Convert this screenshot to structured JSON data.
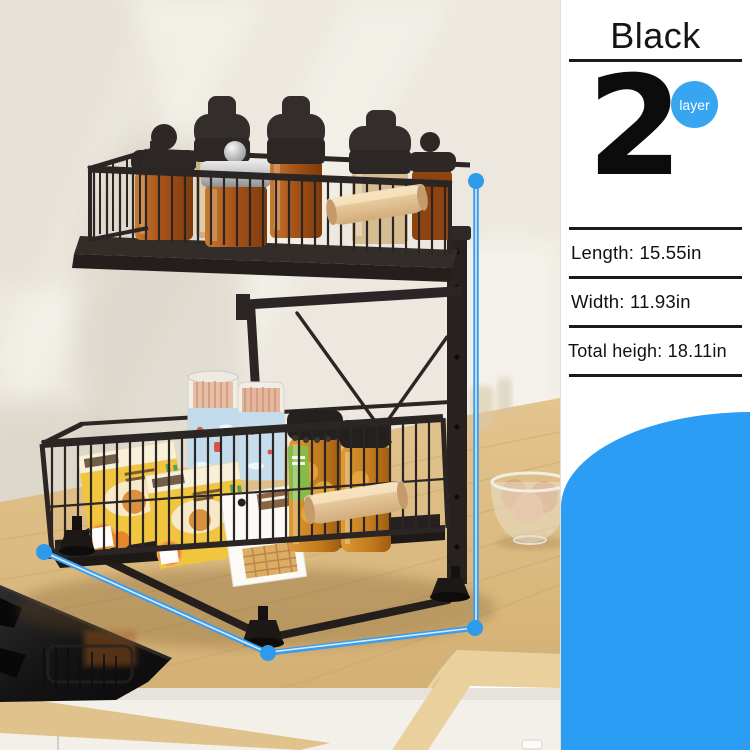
{
  "product_card": {
    "color_title": "Black",
    "layer_count": "2",
    "layer_badge_label": "layer",
    "specs": [
      {
        "label": "Length: 15.55in"
      },
      {
        "label": "Width: 11.93in"
      },
      {
        "label": "Total heigh: 18.11in"
      }
    ]
  },
  "colors": {
    "badge_blue": "#38A5F1",
    "corner_shape_blue": "#2B9DF4",
    "dimension_marker_blue": "#3B9DEB",
    "panel_divider_black": "#1A1A1A",
    "wall_cream": "#EDE9E0",
    "wood_counter": "#DCBC85",
    "rack_black": "#2B2524",
    "jar_amber": "#B05A1A",
    "snack_box_yellow": "#F2C53F",
    "handle_wood": "#E6C396",
    "cooktop_black": "#151312"
  }
}
